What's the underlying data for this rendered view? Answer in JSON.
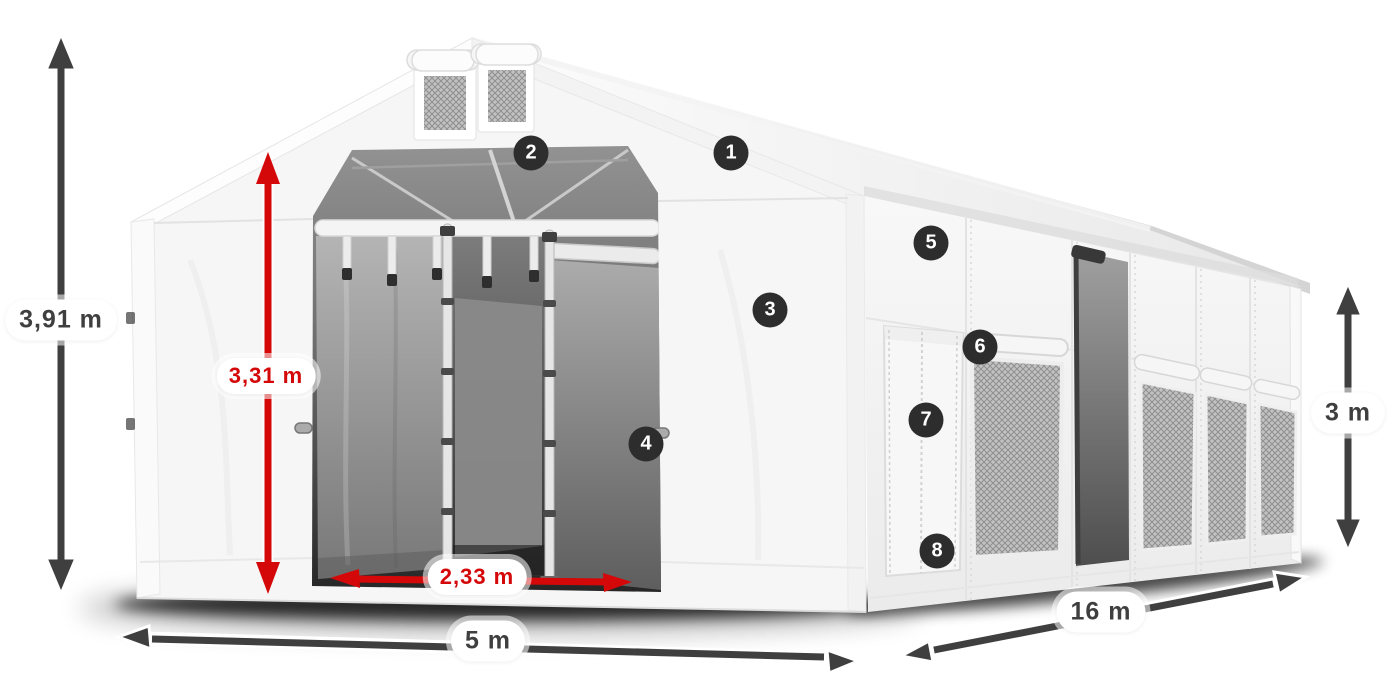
{
  "dimensions": {
    "total_height": "3,91 m",
    "entrance_height": "3,31 m",
    "entrance_width": "2,33 m",
    "front_width": "5 m",
    "side_length": "16 m",
    "side_wall_height": "3 m"
  },
  "callouts": [
    {
      "number": "1"
    },
    {
      "number": "2"
    },
    {
      "number": "3"
    },
    {
      "number": "4"
    },
    {
      "number": "5"
    },
    {
      "number": "6"
    },
    {
      "number": "7"
    },
    {
      "number": "8"
    }
  ],
  "colors": {
    "dimension_red": "#d40808",
    "dimension_dark": "#3f3f3f",
    "badge_background": "#2d2d2d",
    "badge_text": "#ffffff",
    "tent_white": "#f6f6f6",
    "mesh_gray": "#c2c2c2",
    "interior_dark": "#2f2f2f"
  }
}
